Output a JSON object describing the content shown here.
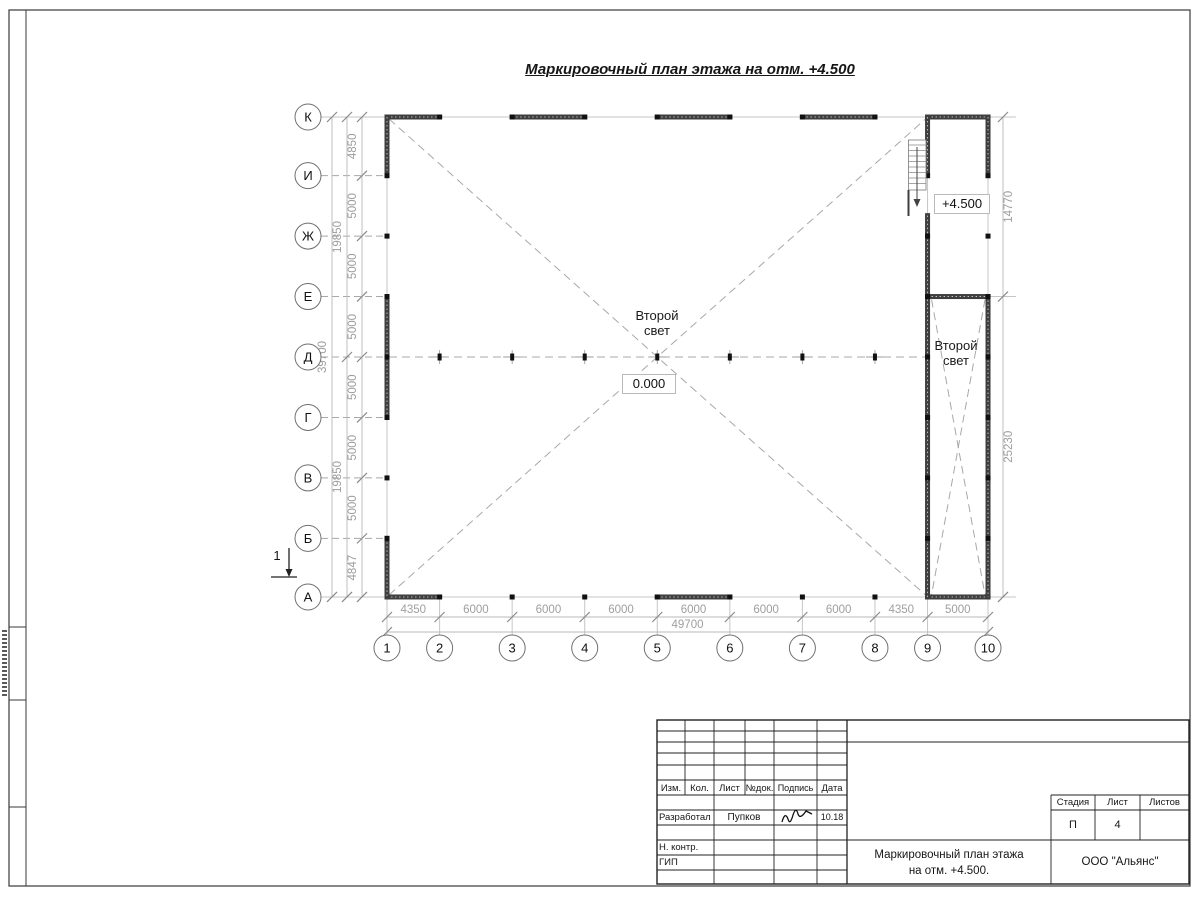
{
  "sheet": {
    "title": "Маркировочный план этажа на отм. +4.500"
  },
  "plan": {
    "letter_axes": [
      "К",
      "И",
      "Ж",
      "Е",
      "Д",
      "Г",
      "В",
      "Б",
      "А"
    ],
    "number_axes": [
      "1",
      "2",
      "3",
      "4",
      "5",
      "6",
      "7",
      "8",
      "9",
      "10"
    ],
    "dims_vertical_mm": [
      4850,
      5000,
      5000,
      5000,
      5000,
      5000,
      5000,
      4847
    ],
    "dims_vertical_totals": [
      "19850",
      "19850"
    ],
    "dim_vertical_overall": "39700",
    "dims_horizontal_mm": [
      4350,
      6000,
      6000,
      6000,
      6000,
      6000,
      6000,
      4350,
      5000
    ],
    "dim_horizontal_overall": "49700",
    "dims_right": [
      "14770",
      "25230"
    ],
    "labels": {
      "second_light_main": "Второй\nсвет",
      "second_light_annex": "Второй\nсвет",
      "level_zero": "0.000",
      "level_upper": "+4.500",
      "section_mark": "1"
    }
  },
  "titleblock": {
    "header_cols": [
      "Изм.",
      "Кол.",
      "Лист",
      "№док.",
      "Подпись",
      "Дата"
    ],
    "developed_label": "Разработал",
    "developed_name": "Пупков",
    "developed_date": "10.18",
    "ncontr_label": "Н. контр.",
    "gip_label": "ГИП",
    "stage_label": "Стадия",
    "sheet_label": "Лист",
    "sheets_label": "Листов",
    "stage_value": "П",
    "sheet_value": "4",
    "sheets_value": "",
    "doc_title_line1": "Маркировочный план этажа",
    "doc_title_line2": "на отм. +4.500.",
    "company": "ООО \"Альянс\""
  },
  "colors": {
    "line_dark": "#1c1c1c",
    "dim_gray": "#9e9e9e",
    "light_gray": "#c6c6c6",
    "dash_gray": "#a8a8a8",
    "wall": "#3e3e3e"
  }
}
